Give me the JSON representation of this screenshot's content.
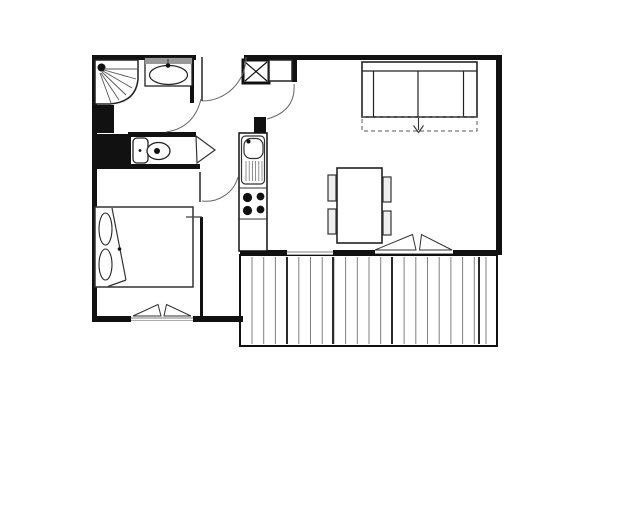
{
  "title": "apartment-floor-plan",
  "canvas": {
    "width": 640,
    "height": 524,
    "background": "#ffffff"
  },
  "colors": {
    "wall": "#111111",
    "fixture": "#222222",
    "line": "#333333",
    "swing": "#666666",
    "deck": "#808080",
    "deck_dark": "#2a2a2a",
    "glass": "#999999",
    "backsplash": "#999999",
    "chair_fill": "#eeeeee",
    "white": "#ffffff"
  },
  "plan": {
    "elements": [
      {
        "name": "balcony-floor",
        "t": "rect",
        "x": 240,
        "y": 255,
        "w": 257,
        "h": 91,
        "s": "#111111",
        "sw": 2,
        "f": "#ffffff"
      },
      {
        "name": "balcony-decking",
        "t": "deck",
        "x0": 252,
        "x1": 487,
        "step": 11.7,
        "y1": 257,
        "y2": 344,
        "s": "#808080",
        "sw": 1,
        "dark": [
          287,
          333,
          392,
          479
        ],
        "ds": "#2a2a2a",
        "dsw": 2
      },
      {
        "name": "wall-top-left",
        "t": "rect",
        "x": 92,
        "y": 55,
        "w": 104,
        "h": 5,
        "f": "#111111"
      },
      {
        "name": "wall-top-right",
        "t": "rect",
        "x": 244,
        "y": 55,
        "w": 258,
        "h": 5,
        "f": "#111111"
      },
      {
        "name": "wall-left",
        "t": "rect",
        "x": 92,
        "y": 55,
        "w": 5,
        "h": 267,
        "f": "#111111"
      },
      {
        "name": "wall-right",
        "t": "rect",
        "x": 496,
        "y": 55,
        "w": 6,
        "h": 200,
        "f": "#111111"
      },
      {
        "name": "wall-bedroom-south-left",
        "t": "rect",
        "x": 92,
        "y": 316,
        "w": 39,
        "h": 6,
        "f": "#111111"
      },
      {
        "name": "wall-bedroom-south-right",
        "t": "rect",
        "x": 193,
        "y": 316,
        "w": 50,
        "h": 6,
        "f": "#111111"
      },
      {
        "name": "wall-living-south-1",
        "t": "rect",
        "x": 240,
        "y": 250,
        "w": 47,
        "h": 5,
        "f": "#111111"
      },
      {
        "name": "wall-living-south-2",
        "t": "rect",
        "x": 333,
        "y": 250,
        "w": 42,
        "h": 5,
        "f": "#111111"
      },
      {
        "name": "wall-living-south-3",
        "t": "rect",
        "x": 453,
        "y": 250,
        "w": 49,
        "h": 5,
        "f": "#111111"
      },
      {
        "name": "wall-bathroom-east",
        "t": "rect",
        "x": 190,
        "y": 57,
        "w": 4,
        "h": 46,
        "f": "#111111"
      },
      {
        "name": "wall-shower-block",
        "t": "rect",
        "x": 92,
        "y": 105,
        "w": 22,
        "h": 28,
        "f": "#111111"
      },
      {
        "name": "wall-wc-block",
        "t": "rect",
        "x": 92,
        "y": 134,
        "w": 39,
        "h": 30,
        "f": "#111111"
      },
      {
        "name": "wall-wc-north",
        "t": "rect",
        "x": 128,
        "y": 132,
        "w": 68,
        "h": 5,
        "f": "#111111"
      },
      {
        "name": "wall-wc-south",
        "t": "rect",
        "x": 92,
        "y": 164,
        "w": 108,
        "h": 5,
        "f": "#111111"
      },
      {
        "name": "wall-kitchen-stub",
        "t": "rect",
        "x": 254,
        "y": 117,
        "w": 12,
        "h": 16,
        "f": "#111111"
      },
      {
        "name": "wall-entry-post",
        "t": "rect",
        "x": 292,
        "y": 57,
        "w": 5,
        "h": 25,
        "f": "#111111"
      },
      {
        "name": "wall-bedroom-partition",
        "t": "rect",
        "x": 200,
        "y": 217,
        "w": 3,
        "h": 99,
        "f": "#111111"
      },
      {
        "name": "window-living-glass-1a",
        "t": "line",
        "x1": 287,
        "y1": 252,
        "x2": 333,
        "y2": 252,
        "s": "#999999",
        "sw": 1.3
      },
      {
        "name": "window-living-glass-1b",
        "t": "line",
        "x1": 287,
        "y1": 254.5,
        "x2": 333,
        "y2": 254.5,
        "s": "#aaaaaa",
        "sw": 1
      },
      {
        "name": "window-living-glass-2",
        "t": "line",
        "x1": 375,
        "y1": 253.5,
        "x2": 453,
        "y2": 253.5,
        "s": "#999999",
        "sw": 1
      },
      {
        "name": "window-bedroom-glass-a",
        "t": "line",
        "x1": 131,
        "y1": 318,
        "x2": 193,
        "y2": 318,
        "s": "#999999",
        "sw": 1.3
      },
      {
        "name": "window-bedroom-glass-b",
        "t": "line",
        "x1": 131,
        "y1": 320.5,
        "x2": 193,
        "y2": 320.5,
        "s": "#aaaaaa",
        "sw": 1
      },
      {
        "name": "casement-bedroom-left",
        "t": "poly",
        "pts": "133,316 158,304.5 161,316",
        "s": "#333333",
        "sw": 1,
        "f": "#ffffff"
      },
      {
        "name": "casement-bedroom-right",
        "t": "poly",
        "pts": "164,316 166.5,304.5 191,316",
        "s": "#333333",
        "sw": 1,
        "f": "#ffffff"
      },
      {
        "name": "casement-living-left",
        "t": "poly",
        "pts": "375,250 412.5,234.5 416,250",
        "s": "#333333",
        "sw": 1,
        "f": "#ffffff"
      },
      {
        "name": "casement-living-right",
        "t": "poly",
        "pts": "419.5,250 421.5,234.5 452,250",
        "s": "#333333",
        "sw": 1,
        "f": "#ffffff"
      },
      {
        "name": "shower-tray",
        "t": "path",
        "d": "M95,60 L138,60 L138,79 Q136,102 110,104 L95,104 Z",
        "s": "#222222",
        "sw": 1.5,
        "f": "#ffffff"
      },
      {
        "name": "shower-head",
        "t": "circle",
        "cx": 101.5,
        "cy": 67.5,
        "r": 4,
        "f": "#111111"
      },
      {
        "name": "shower-spray-1",
        "t": "line",
        "x1": 104,
        "y1": 69,
        "x2": 137,
        "y2": 69,
        "s": "#555555",
        "sw": 0.9
      },
      {
        "name": "shower-spray-2",
        "t": "line",
        "x1": 104,
        "y1": 70,
        "x2": 136,
        "y2": 79,
        "s": "#555555",
        "sw": 0.9
      },
      {
        "name": "shower-spray-3",
        "t": "line",
        "x1": 103,
        "y1": 71,
        "x2": 132,
        "y2": 88,
        "s": "#555555",
        "sw": 0.9
      },
      {
        "name": "shower-spray-4",
        "t": "line",
        "x1": 102,
        "y1": 72,
        "x2": 126,
        "y2": 95,
        "s": "#555555",
        "sw": 0.9
      },
      {
        "name": "shower-spray-5",
        "t": "line",
        "x1": 101,
        "y1": 73,
        "x2": 119,
        "y2": 100,
        "s": "#555555",
        "sw": 0.9
      },
      {
        "name": "shower-spray-6",
        "t": "line",
        "x1": 100,
        "y1": 73,
        "x2": 111,
        "y2": 103,
        "s": "#555555",
        "sw": 0.9
      },
      {
        "name": "washbasin-counter",
        "t": "rect",
        "x": 145,
        "y": 58,
        "w": 47,
        "h": 28,
        "s": "#222222",
        "sw": 1.3,
        "f": "#ffffff"
      },
      {
        "name": "washbasin-backsplash",
        "t": "rect",
        "x": 145,
        "y": 58,
        "w": 47,
        "h": 6,
        "f": "#999999"
      },
      {
        "name": "washbasin-bowl",
        "t": "ellipse",
        "cx": 168.5,
        "cy": 75,
        "rx": 19,
        "ry": 9.5,
        "s": "#222222",
        "sw": 1.2,
        "f": "#ffffff"
      },
      {
        "name": "washbasin-faucet",
        "t": "circle",
        "cx": 168,
        "cy": 65.5,
        "r": 2.3,
        "f": "#111111"
      },
      {
        "name": "washbasin-faucet-tick",
        "t": "line",
        "x1": 168,
        "y1": 59,
        "x2": 168,
        "y2": 63,
        "s": "#333333",
        "sw": 1
      },
      {
        "name": "toilet-cistern",
        "t": "rect",
        "x": 133,
        "y": 138,
        "w": 15,
        "h": 25,
        "rx": 4,
        "s": "#222222",
        "sw": 1.3,
        "f": "#ffffff"
      },
      {
        "name": "toilet-cistern-dot",
        "t": "circle",
        "cx": 140,
        "cy": 150.5,
        "r": 1.4,
        "f": "#111111"
      },
      {
        "name": "toilet-bowl",
        "t": "ellipse",
        "cx": 158.5,
        "cy": 151,
        "rx": 11.5,
        "ry": 8.5,
        "s": "#222222",
        "sw": 1.3,
        "f": "#ffffff"
      },
      {
        "name": "toilet-bowl-dot",
        "t": "circle",
        "cx": 157,
        "cy": 151,
        "r": 3,
        "f": "#111111"
      },
      {
        "name": "wc-door-leaf",
        "t": "poly",
        "pts": "196,136 215,150 197,163",
        "s": "#333333",
        "sw": 1.2,
        "f": "#ffffff"
      },
      {
        "name": "closet-xbox",
        "t": "rect",
        "x": 243,
        "y": 60,
        "w": 26,
        "h": 23,
        "s": "#111111",
        "sw": 3,
        "f": "#ffffff"
      },
      {
        "name": "closet-xbox-diag-1",
        "t": "line",
        "x1": 245,
        "y1": 62,
        "x2": 267,
        "y2": 81,
        "s": "#111111",
        "sw": 1.2
      },
      {
        "name": "closet-xbox-diag-2",
        "t": "line",
        "x1": 267,
        "y1": 62,
        "x2": 245,
        "y2": 81,
        "s": "#111111",
        "sw": 1.2
      },
      {
        "name": "closet-shelf",
        "t": "rect",
        "x": 269,
        "y": 60,
        "w": 23,
        "h": 21,
        "s": "#222222",
        "sw": 1.5,
        "f": "#ffffff"
      },
      {
        "name": "kitchen-unit",
        "t": "rect",
        "x": 239,
        "y": 133,
        "w": 28,
        "h": 118,
        "s": "#111111",
        "sw": 1.5,
        "f": "#ffffff"
      },
      {
        "name": "kitchen-sink-surround",
        "t": "rect",
        "x": 241.5,
        "y": 136,
        "w": 23,
        "h": 48,
        "rx": 4,
        "s": "#333333",
        "sw": 1.2,
        "f": "#ffffff"
      },
      {
        "name": "kitchen-sink-bowl",
        "t": "rect",
        "x": 244,
        "y": 138.5,
        "w": 19,
        "h": 20,
        "rx": 7,
        "s": "#333333",
        "sw": 1.2,
        "f": "#ffffff"
      },
      {
        "name": "kitchen-sink-faucet",
        "t": "circle",
        "cx": 248.5,
        "cy": 141.5,
        "r": 2,
        "f": "#111111"
      },
      {
        "name": "kitchen-sink-drainer",
        "t": "deck",
        "x0": 246,
        "x1": 262.5,
        "step": 3.2,
        "y1": 161,
        "y2": 181,
        "s": "#777777",
        "sw": 0.8,
        "dark": [],
        "ds": "#777777",
        "dsw": 0.8
      },
      {
        "name": "kitchen-stove-top-edge",
        "t": "line",
        "x1": 239,
        "y1": 188,
        "x2": 267,
        "y2": 188,
        "s": "#333333",
        "sw": 1
      },
      {
        "name": "kitchen-burner-1",
        "t": "circle",
        "cx": 247.5,
        "cy": 197.5,
        "r": 4.6,
        "f": "#111111"
      },
      {
        "name": "kitchen-burner-2",
        "t": "circle",
        "cx": 260.5,
        "cy": 196.5,
        "r": 3.9,
        "f": "#111111"
      },
      {
        "name": "kitchen-burner-3",
        "t": "circle",
        "cx": 247.5,
        "cy": 210.5,
        "r": 4.6,
        "f": "#111111"
      },
      {
        "name": "kitchen-burner-4",
        "t": "circle",
        "cx": 260.5,
        "cy": 209.5,
        "r": 3.9,
        "f": "#111111"
      },
      {
        "name": "kitchen-stove-bottom-edge",
        "t": "line",
        "x1": 239,
        "y1": 219,
        "x2": 267,
        "y2": 219,
        "s": "#333333",
        "sw": 1
      },
      {
        "name": "sofa-body",
        "t": "rect",
        "x": 362,
        "y": 62,
        "w": 115,
        "h": 55,
        "s": "#222222",
        "sw": 1.6,
        "f": "#ffffff"
      },
      {
        "name": "sofa-back-edge",
        "t": "line",
        "x1": 362,
        "y1": 71,
        "x2": 477,
        "y2": 71,
        "s": "#222222",
        "sw": 1.2
      },
      {
        "name": "sofa-armrest-left",
        "t": "line",
        "x1": 373.5,
        "y1": 71,
        "x2": 373.5,
        "y2": 117,
        "s": "#222222",
        "sw": 1.2
      },
      {
        "name": "sofa-armrest-right",
        "t": "line",
        "x1": 463.5,
        "y1": 71,
        "x2": 463.5,
        "y2": 117,
        "s": "#222222",
        "sw": 1.2
      },
      {
        "name": "sofa-cushion-divider",
        "t": "line",
        "x1": 418,
        "y1": 71,
        "x2": 418,
        "y2": 117,
        "s": "#222222",
        "sw": 1.2
      },
      {
        "name": "sofa-bed-extension",
        "t": "rect",
        "x": 362,
        "y": 117,
        "w": 115,
        "h": 14,
        "s": "#555555",
        "sw": 1,
        "f": "none",
        "dash": "4,3"
      },
      {
        "name": "sofa-bed-arrow-stem",
        "t": "line",
        "x1": 418.5,
        "y1": 118,
        "x2": 418.5,
        "y2": 130,
        "s": "#333333",
        "sw": 1.1
      },
      {
        "name": "sofa-bed-arrow-head",
        "t": "path",
        "d": "M413.5,125.5 L418.5,132.5 L423.5,125.5",
        "s": "#333333",
        "sw": 1.1,
        "f": "none"
      },
      {
        "name": "dining-table",
        "t": "rect",
        "x": 337,
        "y": 168,
        "w": 45,
        "h": 75,
        "s": "#222222",
        "sw": 1.6,
        "f": "#ffffff"
      },
      {
        "name": "chair-left-1",
        "t": "rect",
        "x": 328,
        "y": 175,
        "w": 8,
        "h": 26,
        "s": "#333333",
        "sw": 1.2,
        "f": "#eeeeee"
      },
      {
        "name": "chair-left-2",
        "t": "rect",
        "x": 328,
        "y": 209,
        "w": 8,
        "h": 25,
        "s": "#333333",
        "sw": 1.2,
        "f": "#eeeeee"
      },
      {
        "name": "chair-right-1",
        "t": "rect",
        "x": 383,
        "y": 177,
        "w": 8,
        "h": 25,
        "s": "#333333",
        "sw": 1.2,
        "f": "#eeeeee"
      },
      {
        "name": "chair-right-2",
        "t": "rect",
        "x": 383,
        "y": 211,
        "w": 8,
        "h": 24,
        "s": "#333333",
        "sw": 1.2,
        "f": "#eeeeee"
      },
      {
        "name": "bed-frame",
        "t": "rect",
        "x": 95,
        "y": 207,
        "w": 98,
        "h": 80,
        "s": "#333333",
        "sw": 1.5,
        "f": "#ffffff"
      },
      {
        "name": "bed-pillow-1",
        "t": "ellipse",
        "cx": 105.5,
        "cy": 229,
        "rx": 6.5,
        "ry": 16,
        "s": "#222222",
        "sw": 1.1,
        "f": "#ffffff"
      },
      {
        "name": "bed-pillow-2",
        "t": "ellipse",
        "cx": 105.5,
        "cy": 264.5,
        "rx": 6.5,
        "ry": 15.5,
        "s": "#222222",
        "sw": 1.1,
        "f": "#ffffff"
      },
      {
        "name": "bed-fold-line-1",
        "t": "line",
        "x1": 112,
        "y1": 208,
        "x2": 126,
        "y2": 280,
        "s": "#333333",
        "sw": 1.2
      },
      {
        "name": "bed-fold-line-2",
        "t": "line",
        "x1": 126,
        "y1": 280,
        "x2": 108,
        "y2": 286.5,
        "s": "#333333",
        "sw": 1.2
      },
      {
        "name": "bed-fold-dot",
        "t": "circle",
        "cx": 119.5,
        "cy": 249,
        "r": 1.8,
        "f": "#111111"
      },
      {
        "name": "entry-door-leaf",
        "t": "line",
        "x1": 202,
        "y1": 57,
        "x2": 202,
        "y2": 101,
        "s": "#333333",
        "sw": 1.6
      },
      {
        "name": "entry-door-swing",
        "t": "path",
        "d": "M202,101 A44,44 0 0 0 246,57",
        "s": "#666666",
        "sw": 1,
        "f": "none"
      },
      {
        "name": "living-door-swing",
        "t": "path",
        "d": "M294,84 Q296,111 267,119",
        "s": "#666666",
        "sw": 1,
        "f": "none"
      },
      {
        "name": "bathroom-door-swing",
        "t": "path",
        "d": "M201,99 Q194,128 166,132",
        "s": "#666666",
        "sw": 1,
        "f": "none"
      },
      {
        "name": "bedroom-door-leaf",
        "t": "line",
        "x1": 200,
        "y1": 172,
        "x2": 200,
        "y2": 202,
        "s": "#333333",
        "sw": 1.6
      },
      {
        "name": "bedroom-door-swing",
        "t": "path",
        "d": "M202,201 A33,33 0 0 0 238,177",
        "s": "#666666",
        "sw": 1,
        "f": "none"
      },
      {
        "name": "bedroom-wall-jog",
        "t": "line",
        "x1": 186,
        "y1": 217,
        "x2": 202,
        "y2": 217,
        "s": "#444444",
        "sw": 1.3
      }
    ]
  }
}
